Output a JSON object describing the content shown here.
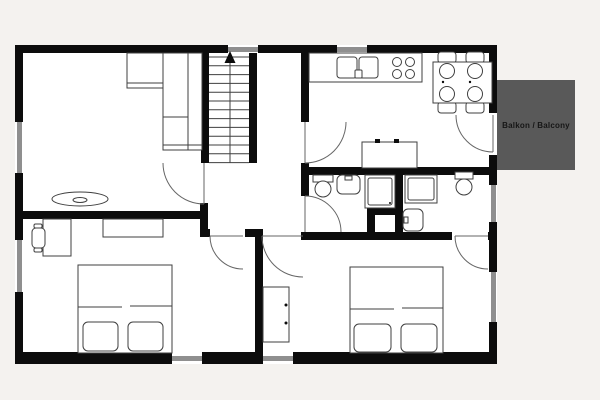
{
  "title": "Apartment floor plan",
  "balcony": {
    "label": "Balkon / Balcony"
  },
  "colors": {
    "background": "#f4f2ef",
    "floor": "#ffffff",
    "wall": "#0c0c0c",
    "window_glass": "#8f8f8f",
    "balcony_fill": "#595959",
    "balcony_text": "#161616",
    "line": "#3f3f3f"
  },
  "legend": {
    "fixture_icons": [
      "staircase-icon",
      "up-arrow-icon",
      "door-swing-icon",
      "window-icon",
      "corner-sofa-icon",
      "coffee-table-icon",
      "kitchen-counter-icon",
      "kitchen-sink-icon",
      "stove-icon",
      "dining-table-icon",
      "dining-chair-icon",
      "sideboard-icon",
      "toilet-icon",
      "washbasin-icon",
      "shower-icon",
      "double-bed-icon",
      "wardrobe-icon",
      "desk-icon",
      "desk-chair-icon",
      "dresser-icon"
    ]
  }
}
